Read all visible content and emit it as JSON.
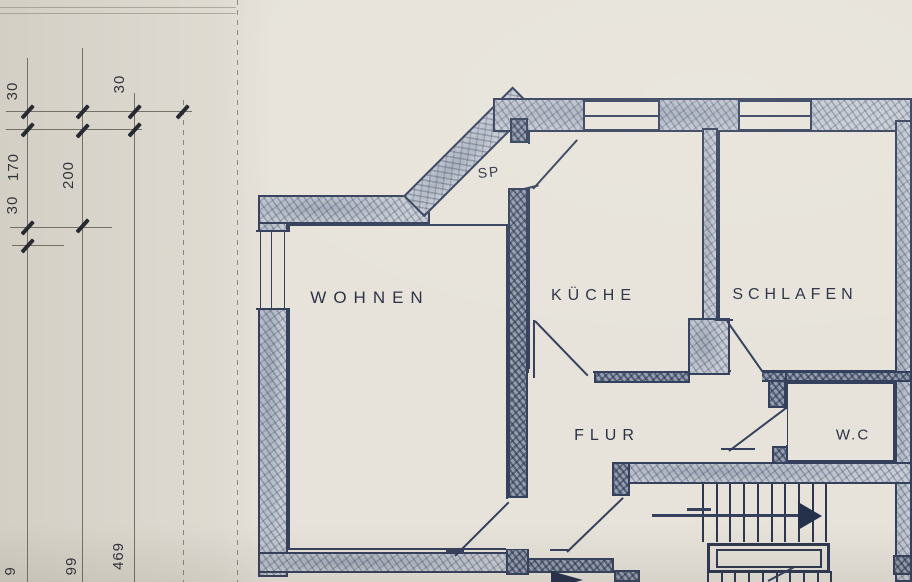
{
  "drawing": {
    "kind": "scanned architectural floor plan (blueprint photo)",
    "rooms": [
      {
        "id": "wohnen",
        "label": "WOHNEN"
      },
      {
        "id": "kueche",
        "label": "KÜCHE"
      },
      {
        "id": "schlafen",
        "label": "SCHLAFEN"
      },
      {
        "id": "flur",
        "label": "FLUR"
      },
      {
        "id": "wc",
        "label": "W.C"
      },
      {
        "id": "sp",
        "label": "SP"
      }
    ],
    "dims": {
      "upper": [
        "30",
        "170",
        "30",
        "200",
        "30"
      ],
      "lower": [
        "9",
        "99",
        "469"
      ]
    },
    "features": {
      "stair_direction": "arrow pointing right (up-run of staircase)",
      "windows": 3,
      "doors": 6
    },
    "colors": {
      "paper": "#e7e3da",
      "ink": "#35405c",
      "wall_fill": "#c7ccd4",
      "pencil": "#5a564c"
    }
  }
}
